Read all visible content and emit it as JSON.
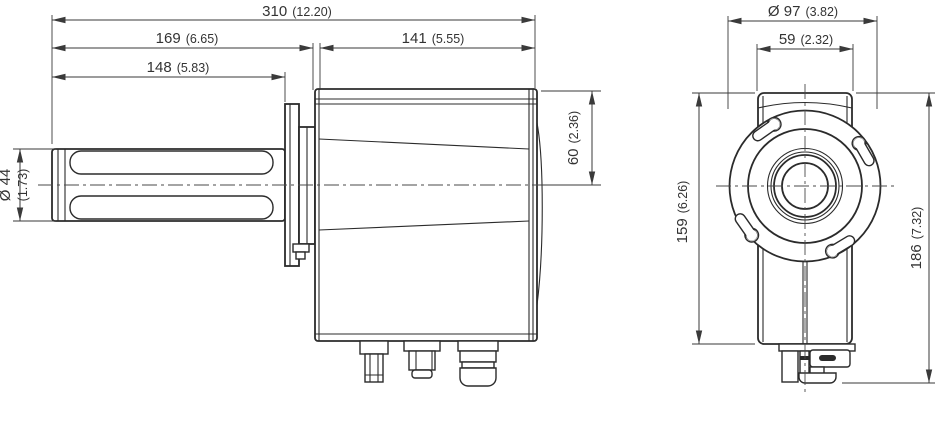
{
  "drawing": {
    "type": "dimensional-technical-drawing",
    "line_color": "#2b2b2b",
    "views": {
      "side": {
        "dims": {
          "overall_length": {
            "mm": "310",
            "inch": "(12.20)"
          },
          "front_to_body": {
            "mm": "169",
            "inch": "(6.65)"
          },
          "probe_length": {
            "mm": "148",
            "inch": "(5.83)"
          },
          "body_length": {
            "mm": "141",
            "inch": "(5.55)"
          },
          "probe_diameter": {
            "mm": "Ø 44",
            "inch": "(1.73)"
          },
          "top_to_center": {
            "mm": "60",
            "inch": "(2.36)"
          }
        }
      },
      "front": {
        "dims": {
          "flange_diameter": {
            "mm": "Ø 97",
            "inch": "(3.82)"
          },
          "body_width": {
            "mm": "59",
            "inch": "(2.32)"
          },
          "body_height": {
            "mm": "159",
            "inch": "(6.26)"
          },
          "overall_height": {
            "mm": "186",
            "inch": "(7.32)"
          }
        }
      }
    }
  }
}
